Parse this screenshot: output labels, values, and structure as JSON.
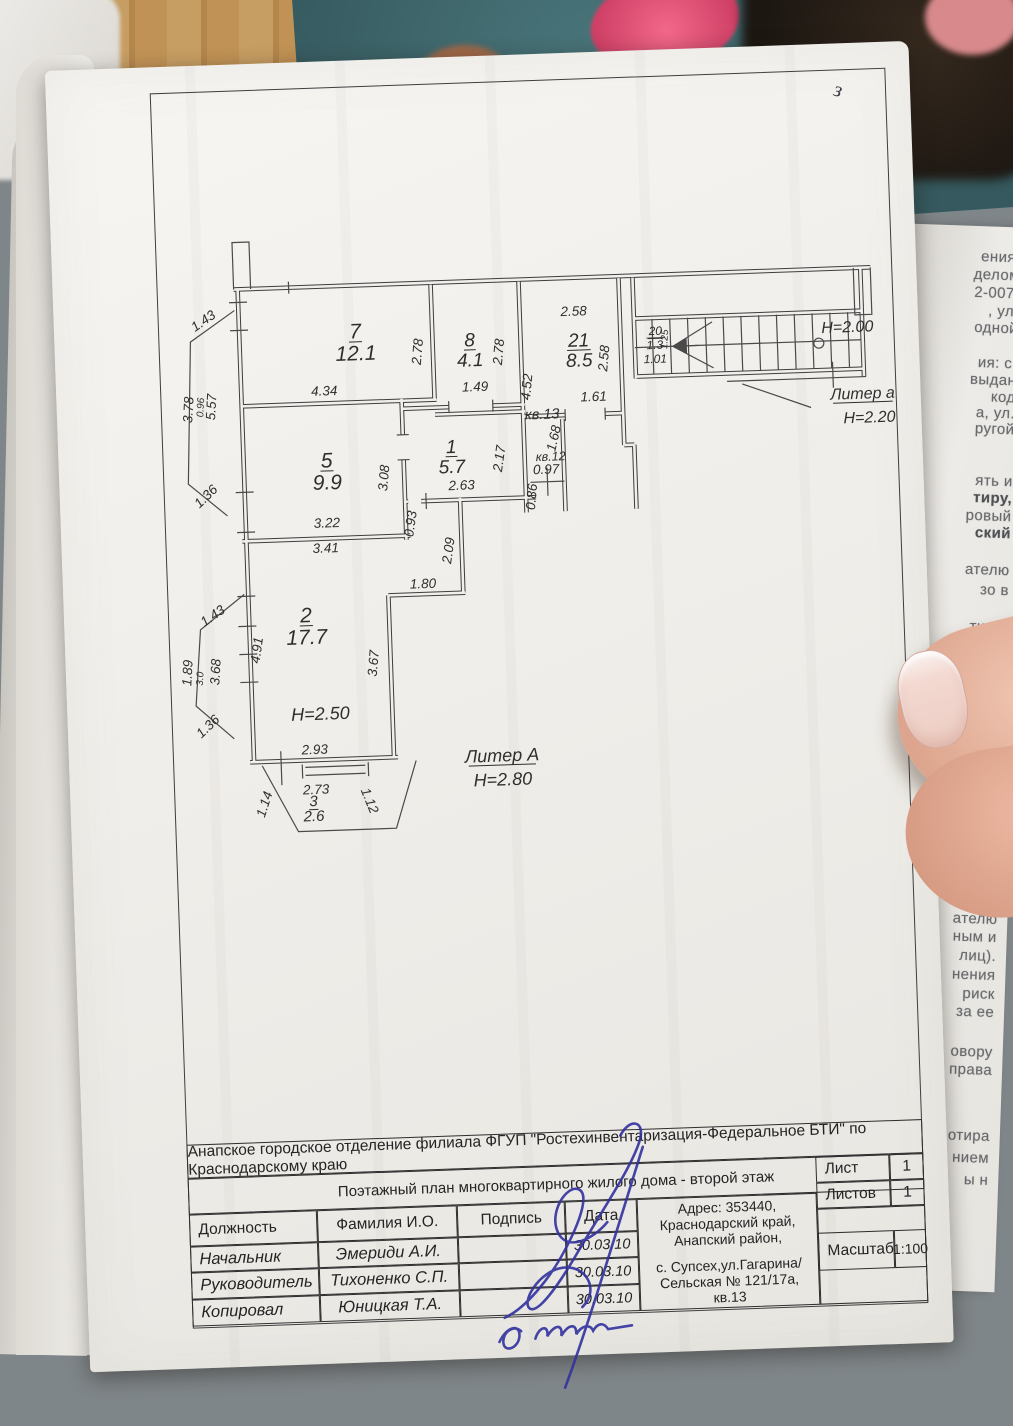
{
  "accent_colors": {
    "paper": "#f1efec",
    "ink": "#2e2e2e",
    "signature_blue": "#32329f",
    "carpet_teal": "#3f6a70",
    "slipper_pink": "#e05577"
  },
  "page_mark": "з",
  "document": {
    "org_line": "Анапское городское отделение филиала ФГУП \"Ростехинвентаризация-Федеральное БТИ\" по Краснодарскому краю",
    "title_line": "Поэтажный план многоквартирного жилого дома - второй этаж",
    "address_line1": "Адрес: 353440, Краснодарский край, Анапский район,",
    "address_line2": "с. Супсех,ул.Гагарина/Сельская № 121/17а, кв.13",
    "col_role": "Должность",
    "col_name": "Фамилия И.О.",
    "col_sign": "Подпись",
    "col_date": "Дата",
    "rows": [
      {
        "role": "Начальник",
        "name": "Эмериди А.И.",
        "date": "30.03.10"
      },
      {
        "role": "Руководитель",
        "name": "Тихоненко С.П.",
        "date": "30.03.10"
      },
      {
        "role": "Копировал",
        "name": "Юницкая Т.А.",
        "date": "30.03.10"
      }
    ],
    "sheet_label": "Лист",
    "sheet_value": "1",
    "sheets_label": "Листов",
    "sheets_value": "1",
    "scale_label": "Масштаб",
    "scale_value": "1:100"
  },
  "plan": {
    "labels": [
      {
        "t": "7",
        "x": 205,
        "y": 112,
        "s": 21,
        "u": true
      },
      {
        "t": "12.1",
        "x": 205,
        "y": 134,
        "s": 21
      },
      {
        "t": "8",
        "x": 319,
        "y": 124,
        "s": 19,
        "u": true
      },
      {
        "t": "4.1",
        "x": 319,
        "y": 144,
        "s": 19
      },
      {
        "t": "21",
        "x": 428,
        "y": 128,
        "s": 19,
        "u": true
      },
      {
        "t": "8.5",
        "x": 428,
        "y": 148,
        "s": 19
      },
      {
        "t": "1",
        "x": 297,
        "y": 230,
        "s": 19,
        "u": true
      },
      {
        "t": "5.7",
        "x": 297,
        "y": 250,
        "s": 19
      },
      {
        "t": "5",
        "x": 172,
        "y": 240,
        "s": 21,
        "u": true
      },
      {
        "t": "9.9",
        "x": 172,
        "y": 262,
        "s": 21
      },
      {
        "t": "2",
        "x": 146,
        "y": 394,
        "s": 21,
        "u": true
      },
      {
        "t": "17.7",
        "x": 146,
        "y": 416,
        "s": 21
      },
      {
        "t": "3",
        "x": 147,
        "y": 578,
        "s": 15,
        "u": true
      },
      {
        "t": "2.6",
        "x": 147,
        "y": 593,
        "s": 15
      },
      {
        "t": "4.34",
        "x": 172,
        "y": 168
      },
      {
        "t": "2.78",
        "x": 271,
        "y": 128,
        "r": -83
      },
      {
        "t": "2.78",
        "x": 352,
        "y": 131,
        "r": -83
      },
      {
        "t": "1.49",
        "x": 323,
        "y": 169
      },
      {
        "t": "2.58",
        "x": 424,
        "y": 97
      },
      {
        "t": "2.58",
        "x": 457,
        "y": 141,
        "r": -83
      },
      {
        "t": "4.52",
        "x": 379,
        "y": 167,
        "r": -83
      },
      {
        "t": "1.61",
        "x": 441,
        "y": 183
      },
      {
        "t": "кв.13",
        "x": 389,
        "y": 199,
        "s": 14.5
      },
      {
        "t": "1.68",
        "x": 404,
        "y": 220,
        "r": -75
      },
      {
        "t": "кв.12",
        "x": 396,
        "y": 241,
        "s": 12.5
      },
      {
        "t": "0.97",
        "x": 391,
        "y": 254
      },
      {
        "t": "0.86",
        "x": 380,
        "y": 277,
        "r": -83
      },
      {
        "t": "2.17",
        "x": 349,
        "y": 238,
        "r": -80
      },
      {
        "t": "2.63",
        "x": 306,
        "y": 267
      },
      {
        "t": "3.08",
        "x": 233,
        "y": 253,
        "r": -83
      },
      {
        "t": "3.22",
        "x": 170,
        "y": 300
      },
      {
        "t": "3.41",
        "x": 168,
        "y": 325
      },
      {
        "t": "0.93",
        "x": 258,
        "y": 300,
        "r": -80
      },
      {
        "t": "2.09",
        "x": 295,
        "y": 328,
        "r": -80
      },
      {
        "t": "1.80",
        "x": 264,
        "y": 364
      },
      {
        "t": "3.67",
        "x": 216,
        "y": 438,
        "r": -83
      },
      {
        "t": "4.91",
        "x": 100,
        "y": 421,
        "r": -80
      },
      {
        "t": "2.93",
        "x": 150,
        "y": 526
      },
      {
        "t": "2.73",
        "x": 150,
        "y": 566
      },
      {
        "t": "1.14",
        "x": 102,
        "y": 576,
        "r": -70
      },
      {
        "t": "1.12",
        "x": 199,
        "y": 576,
        "r": 70
      },
      {
        "t": "1.43",
        "x": 56,
        "y": 93,
        "r": -33
      },
      {
        "t": "3.78",
        "x": 40,
        "y": 178,
        "r": -85
      },
      {
        "t": "0.96",
        "x": 51,
        "y": 176,
        "r": -85,
        "s": 10
      },
      {
        "t": "5.57",
        "x": 63,
        "y": 176,
        "r": -85
      },
      {
        "t": "1.36",
        "x": 53,
        "y": 268,
        "r": -42
      },
      {
        "t": "1.43",
        "x": 55,
        "y": 388,
        "r": -33
      },
      {
        "t": "1.89",
        "x": 30,
        "y": 441,
        "r": -85
      },
      {
        "t": "3.0",
        "x": 41,
        "y": 447,
        "r": -85,
        "s": 10
      },
      {
        "t": "3.68",
        "x": 58,
        "y": 441,
        "r": -85
      },
      {
        "t": "1.36",
        "x": 47,
        "y": 498,
        "r": -42
      },
      {
        "t": "20",
        "x": 505,
        "y": 119,
        "s": 12,
        "u": true
      },
      {
        "t": "1.3",
        "x": 504,
        "y": 133,
        "s": 12
      },
      {
        "t": "1.25",
        "x": 517,
        "y": 124,
        "r": -85,
        "s": 10
      },
      {
        "t": "1.01",
        "x": 504,
        "y": 147,
        "s": 12
      },
      {
        "t": "H=2.00",
        "x": 697,
        "y": 123,
        "s": 16
      },
      {
        "t": "Литер а",
        "x": 710,
        "y": 190,
        "s": 16,
        "u": true
      },
      {
        "t": "H=2.20",
        "x": 716,
        "y": 214,
        "s": 16
      },
      {
        "t": "H=2.50",
        "x": 157,
        "y": 492,
        "s": 18
      },
      {
        "t": "Литер А",
        "x": 337,
        "y": 540,
        "s": 18,
        "u": true
      },
      {
        "t": "Н=2.80",
        "x": 337,
        "y": 564,
        "s": 18
      }
    ]
  },
  "side_page": {
    "lines": [
      {
        "t": "ения:",
        "y": 22
      },
      {
        "t": "делом",
        "y": 40
      },
      {
        "t": "2-007,",
        "y": 58
      },
      {
        "t": ", ул.",
        "y": 76
      },
      {
        "t": "одной",
        "y": 93
      },
      {
        "t": "ия: с.",
        "y": 128
      },
      {
        "t": "выдан",
        "y": 145
      },
      {
        "t": "код",
        "y": 162
      },
      {
        "t": "а, ул.",
        "y": 178
      },
      {
        "t": "ругой",
        "y": 194
      },
      {
        "t": "ять и",
        "y": 246
      },
      {
        "t": "тиру,",
        "y": 263,
        "b": true
      },
      {
        "t": "ровый",
        "y": 281
      },
      {
        "t": "ский",
        "y": 298,
        "b": true
      },
      {
        "t": "ателю",
        "y": 335
      },
      {
        "t": "зо  в",
        "y": 355
      },
      {
        "t": "ти на",
        "y": 392
      },
      {
        "t": "делана",
        "y": 410
      },
      {
        "t": "сан",
        "y": 520
      },
      {
        "t": "асчет",
        "y": 538
      },
      {
        "t": "1.",
        "y": 557
      },
      {
        "t": "бодить",
        "y": 577
      },
      {
        "t": "елю в",
        "y": 595
      },
      {
        "t": "права",
        "y": 613
      },
      {
        "t": "енной",
        "y": 632
      },
      {
        "t": "о Акту",
        "y": 666
      },
      {
        "t": "ателю",
        "y": 684
      },
      {
        "t": "ным и",
        "y": 702
      },
      {
        "t": "лиц).",
        "y": 721
      },
      {
        "t": "нения",
        "y": 740
      },
      {
        "t": "риск",
        "y": 759
      },
      {
        "t": "за ее",
        "y": 777
      },
      {
        "t": "овору",
        "y": 817
      },
      {
        "t": "права",
        "y": 835
      },
      {
        "t": "отира",
        "y": 901
      },
      {
        "t": "нием",
        "y": 923
      },
      {
        "t": "ы н",
        "y": 945
      }
    ]
  }
}
